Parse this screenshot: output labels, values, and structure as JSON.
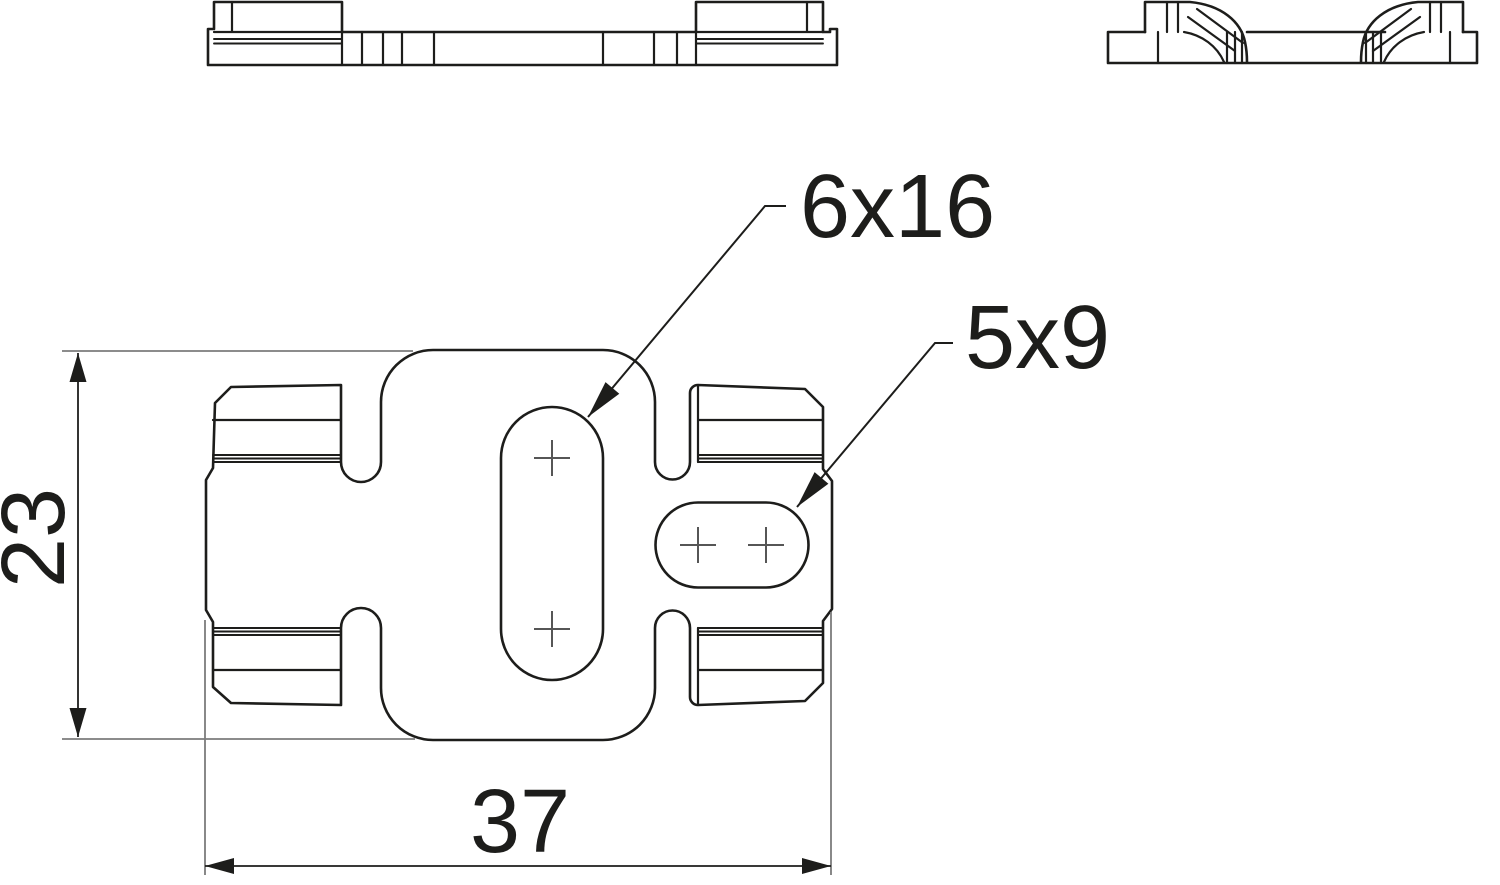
{
  "drawing": {
    "callout_large_slot": "6x16",
    "callout_small_slot": "5x9",
    "dim_height": "23",
    "dim_width": "37"
  },
  "colors": {
    "line": "#1d1d1b",
    "extension_line": "#7c7c7c",
    "background": "#ffffff"
  }
}
